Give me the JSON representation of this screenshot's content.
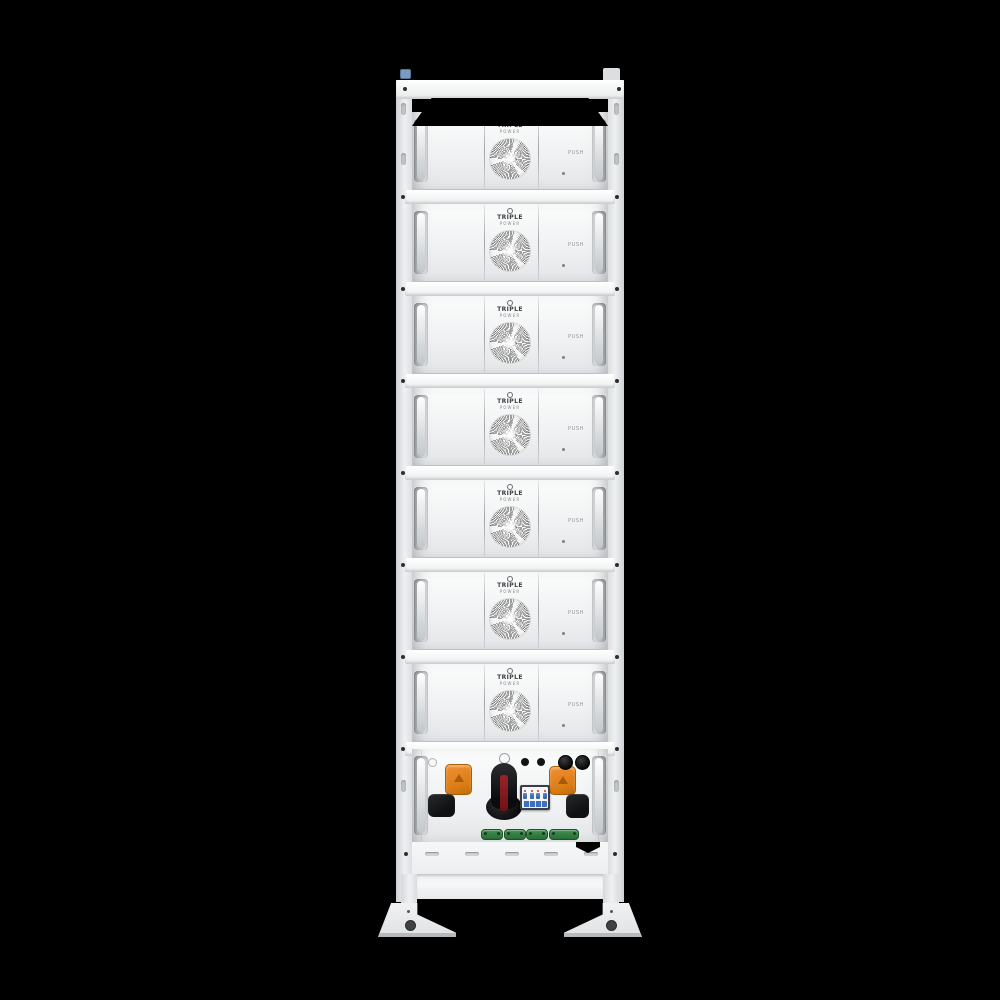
{
  "scene": {
    "name": "stacked-battery-tower-front-view",
    "description": "White rack-mounted battery energy storage tower with stacked battery modules and a bottom control unit, on black background",
    "background_color": "#000000",
    "module_count": 7
  },
  "brand": {
    "logo_top": "TRIPLE",
    "logo_bottom": "POWER"
  },
  "modules": [
    {
      "logo_top": "TRIPLE",
      "logo_bottom": "POWER",
      "push_label": "PUSH"
    },
    {
      "logo_top": "TRIPLE",
      "logo_bottom": "POWER",
      "push_label": "PUSH"
    },
    {
      "logo_top": "TRIPLE",
      "logo_bottom": "POWER",
      "push_label": "PUSH"
    },
    {
      "logo_top": "TRIPLE",
      "logo_bottom": "POWER",
      "push_label": "PUSH"
    },
    {
      "logo_top": "TRIPLE",
      "logo_bottom": "POWER",
      "push_label": "PUSH"
    },
    {
      "logo_top": "TRIPLE",
      "logo_bottom": "POWER",
      "push_label": "PUSH"
    },
    {
      "logo_top": "TRIPLE",
      "logo_bottom": "POWER",
      "push_label": "PUSH"
    }
  ],
  "control_unit": {
    "rotary_switch": "dc-disconnect-rotary-switch",
    "circuit_breaker": "4-pole-mini-circuit-breaker",
    "breaker_pole_count": 4,
    "orange_connector_count": 2,
    "cable_gland_count": 2,
    "small_port_count": 2,
    "rubber_cover_count": 2,
    "terminal_connector_count": 4
  },
  "base": {
    "vent_slot_count": 5
  },
  "colors": {
    "rack_white": "#f2f3f4",
    "connector_orange": "#e0821c",
    "switch_black": "#141416",
    "switch_red": "#8e2024",
    "breaker_blue": "#3f6fc1",
    "terminal_green": "#2f7d3f"
  }
}
